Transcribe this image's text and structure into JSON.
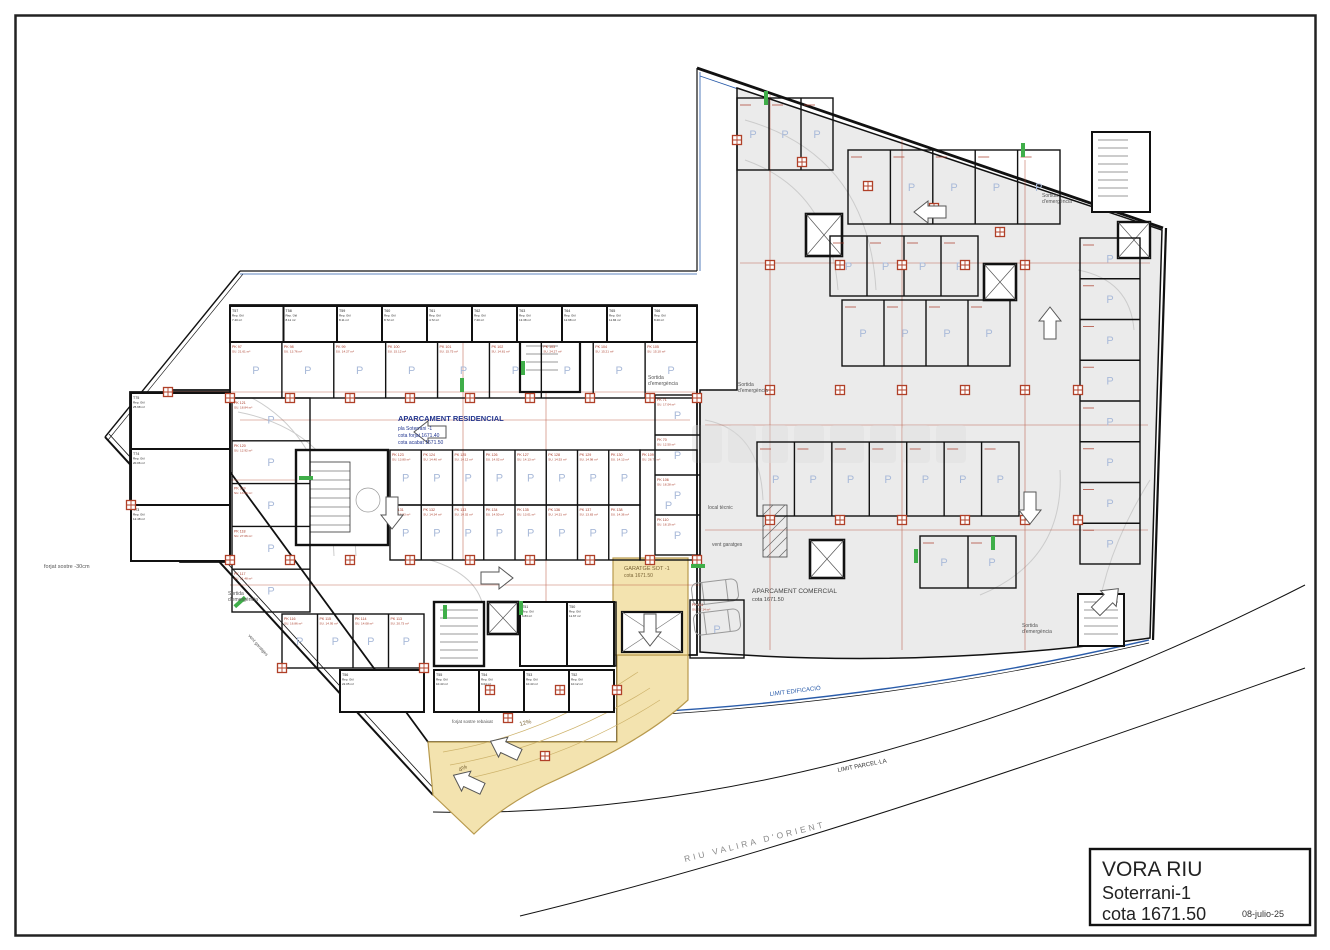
{
  "sheet": {
    "title_block": {
      "project": "VORA RIU",
      "level": "Soterrani-1",
      "elevation": "cota 1671.50",
      "date": "08-julio-25"
    }
  },
  "annotations": {
    "residential": {
      "line1": "APARCAMENT RESIDENCIAL",
      "line2": "pla Soterrani -1",
      "line3": "cota forjat 1671.40",
      "line4": "cota acabat 1671.50"
    },
    "commercial": {
      "line1": "APARCAMENT COMERCIAL",
      "line2": "cota 1671.50"
    },
    "garage": {
      "line1": "GARATGE SOT -1",
      "line2": "cota 1671.50"
    },
    "exit_line1": "Sortida",
    "exit_line2": "d'emergència",
    "vent": "vent garatges",
    "local_tecnic": "local tècnic",
    "forjat_sostre": "forjat sostre -30cm",
    "forjat_rebaixat": "forjat sostre rebaixat",
    "river": "RIU VALIRA D'ORIENT",
    "limit_edificacio": "LIMIT EDIFICACIÓ",
    "limit_parcella": "LIMIT PARCEL·LA",
    "slope_a": "12%",
    "slope_b": "4%"
  },
  "colors": {
    "wall": "#1a1a1a",
    "commercial_floor": "#ebebeb",
    "ramp_fill": "#f3e3af",
    "ramp_stroke": "#b89a4e",
    "boundary_blue": "#2a5caa",
    "dim_red": "#b04028",
    "exit_green": "#3fae49",
    "stall_p": "#a9bad9",
    "label_red": "#a93a28"
  },
  "stall_groups": [
    {
      "name": "storage-top-left",
      "kind": "storage",
      "x": 230,
      "y": 306,
      "w": 107,
      "h": 36,
      "n": 2,
      "dir": "h",
      "labels": [
        [
          "T57",
          "7.40 m²"
        ],
        [
          "T58",
          "8.11 m²"
        ]
      ]
    },
    {
      "name": "storage-top",
      "kind": "storage",
      "x": 337,
      "y": 306,
      "w": 360,
      "h": 36,
      "n": 8,
      "dir": "h",
      "labels": [
        [
          "T59",
          "8.11 m²"
        ],
        [
          "T60",
          "8.72 m²"
        ],
        [
          "T61",
          "4.72 m²"
        ],
        [
          "T62",
          "7.20 m²"
        ],
        [
          "T63",
          "13.38 m²"
        ],
        [
          "T64",
          "12.98 m²"
        ],
        [
          "T65",
          "11.84 m²"
        ],
        [
          "T66",
          "8.20 m²"
        ]
      ]
    },
    {
      "name": "parking-top",
      "kind": "parking",
      "x": 230,
      "y": 342,
      "w": 467,
      "h": 56,
      "n": 9,
      "dir": "h",
      "labels": [
        [
          "PK 97",
          "SU. 21.61 m²"
        ],
        [
          "PK 98",
          "SU. 13.76 m²"
        ],
        [
          "PK 99",
          "SU. 14.27 m²"
        ],
        [
          "PK 100",
          "SU. 15.12 m²"
        ],
        [
          "PK 101",
          "SU. 15.75 m²"
        ],
        [
          "PK 102",
          "SU. 14.81 m²"
        ],
        [
          "PK 103",
          "SU. 24.27 m²"
        ],
        [
          "PK 104",
          "SU. 15.21 m²"
        ],
        [
          "PK 105",
          "SU. 15.10 m²"
        ]
      ]
    },
    {
      "name": "left-wing-storage",
      "kind": "storage",
      "x": 131,
      "y": 393,
      "w": 99,
      "h": 168,
      "n": 3,
      "dir": "v",
      "labels": [
        [
          "T75",
          "25.98 m²"
        ],
        [
          "T74",
          "20.06 m²"
        ],
        [
          "T73",
          "12.48 m²"
        ]
      ]
    },
    {
      "name": "left-column-parking",
      "kind": "parking",
      "x": 232,
      "y": 398,
      "w": 78,
      "h": 214,
      "n": 5,
      "dir": "v",
      "labels": [
        [
          "PK 121",
          "SU. 18.84 m²"
        ],
        [
          "PK 120",
          "SU. 12.92 m²"
        ],
        [
          "PK 119",
          "SU. 13.86 m²"
        ],
        [
          "PK 118",
          "SU. 27.06 m²"
        ],
        [
          "PK 117",
          "SU. 21.48 m²"
        ]
      ]
    },
    {
      "name": "central-row-upper",
      "kind": "parking",
      "x": 390,
      "y": 450,
      "w": 250,
      "h": 55,
      "n": 8,
      "dir": "h",
      "labels": [
        [
          "PK 123",
          "SU. 13.80 m²"
        ],
        [
          "PK 124",
          "SU. 14.40 m²"
        ],
        [
          "PK 125",
          "SU. 14.12 m²"
        ],
        [
          "PK 126",
          "SU. 14.02 m²"
        ],
        [
          "PK 127",
          "SU. 14.13 m²"
        ],
        [
          "PK 128",
          "SU. 14.53 m²"
        ],
        [
          "PK 129",
          "SU. 14.98 m²"
        ],
        [
          "PK 130",
          "SU. 14.13 m²"
        ]
      ]
    },
    {
      "name": "central-row-lower",
      "kind": "parking",
      "x": 390,
      "y": 505,
      "w": 250,
      "h": 55,
      "n": 8,
      "dir": "h",
      "labels": [
        [
          "PK 131",
          "SU. 13.83 m²"
        ],
        [
          "PK 132",
          "SU. 14.34 m²"
        ],
        [
          "PK 133",
          "SU. 14.02 m²"
        ],
        [
          "PK 134",
          "SU. 14.50 m²"
        ],
        [
          "PK 135",
          "SU. 13.01 m²"
        ],
        [
          "PK 136",
          "SU. 14.31 m²"
        ],
        [
          "PK 137",
          "SU. 13.83 m²"
        ],
        [
          "PK 138",
          "SU. 14.36 m²"
        ]
      ]
    },
    {
      "name": "stall-109",
      "kind": "parking",
      "x": 640,
      "y": 450,
      "w": 57,
      "h": 110,
      "n": 1,
      "dir": "h",
      "labels": [
        [
          "PK 109",
          "SU. 28.71 m²"
        ]
      ]
    },
    {
      "name": "mid-column",
      "kind": "parking",
      "x": 655,
      "y": 395,
      "w": 45,
      "h": 160,
      "n": 4,
      "dir": "v",
      "labels": [
        [
          "PK 71",
          "SU. 17.04 m²"
        ],
        [
          "PK 70",
          "SU. 12.50 m²"
        ],
        [
          "PK 106",
          "SU. 18.28 m²"
        ],
        [
          "PK 110",
          "SU. 18.19 m²"
        ]
      ]
    },
    {
      "name": "bottom-parking",
      "kind": "parking",
      "x": 282,
      "y": 614,
      "w": 142,
      "h": 54,
      "n": 4,
      "dir": "h",
      "labels": [
        [
          "PK 116",
          "SU. 16.86 m²"
        ],
        [
          "PK 115",
          "SU. 14.95 m²"
        ],
        [
          "PK 114",
          "SU. 14.08 m²"
        ],
        [
          "PK 113",
          "SU. 20.73 m²"
        ]
      ]
    },
    {
      "name": "bottom-parking-2",
      "kind": "parking",
      "x": 576,
      "y": 602,
      "w": 40,
      "h": 64,
      "n": 1,
      "dir": "h",
      "labels": [
        [
          "PK 112",
          "SU. 18.84 m²"
        ]
      ]
    },
    {
      "name": "bottom-parking-3",
      "kind": "parking",
      "x": 690,
      "y": 600,
      "w": 54,
      "h": 58,
      "n": 1,
      "dir": "h",
      "labels": [
        [
          "PK 111",
          "SU. 17.14 m²"
        ]
      ]
    },
    {
      "name": "bottom-storage-a",
      "kind": "storage",
      "x": 340,
      "y": 670,
      "w": 84,
      "h": 42,
      "n": 1,
      "dir": "h",
      "labels": [
        [
          "T56",
          "22.05 m²"
        ]
      ]
    },
    {
      "name": "bottom-storage-b",
      "kind": "storage",
      "x": 434,
      "y": 670,
      "w": 180,
      "h": 42,
      "n": 4,
      "dir": "h",
      "labels": [
        [
          "T55",
          "10.43 m²"
        ],
        [
          "T54",
          "9.04 m²"
        ],
        [
          "T53",
          "10.43 m²"
        ],
        [
          "T52",
          "10.12 m²"
        ]
      ]
    },
    {
      "name": "bottom-storage-c",
      "kind": "storage",
      "x": 520,
      "y": 602,
      "w": 94,
      "h": 64,
      "n": 2,
      "dir": "h",
      "labels": [
        [
          "T51",
          "6.83 m²"
        ],
        [
          "T50",
          "11.67 m²"
        ]
      ]
    },
    {
      "name": "comm-a1",
      "kind": "commercial",
      "x": 737,
      "y": 98,
      "w": 96,
      "h": 72,
      "n": 3,
      "dir": "h",
      "labels": []
    },
    {
      "name": "comm-a2",
      "kind": "commercial",
      "x": 848,
      "y": 150,
      "w": 212,
      "h": 74,
      "n": 5,
      "dir": "h",
      "labels": []
    },
    {
      "name": "comm-b1",
      "kind": "commercial",
      "x": 830,
      "y": 236,
      "w": 148,
      "h": 60,
      "n": 4,
      "dir": "h",
      "labels": []
    },
    {
      "name": "comm-b2",
      "kind": "commercial",
      "x": 842,
      "y": 300,
      "w": 168,
      "h": 66,
      "n": 4,
      "dir": "h",
      "labels": []
    },
    {
      "name": "comm-c",
      "kind": "commercial",
      "x": 757,
      "y": 442,
      "w": 262,
      "h": 74,
      "n": 7,
      "dir": "h",
      "labels": []
    },
    {
      "name": "comm-e",
      "kind": "commercial",
      "x": 920,
      "y": 536,
      "w": 96,
      "h": 52,
      "n": 2,
      "dir": "h",
      "labels": []
    },
    {
      "name": "comm-right-strip",
      "kind": "commercial",
      "x": 1080,
      "y": 238,
      "w": 60,
      "h": 326,
      "n": 8,
      "dir": "v",
      "labels": []
    }
  ]
}
